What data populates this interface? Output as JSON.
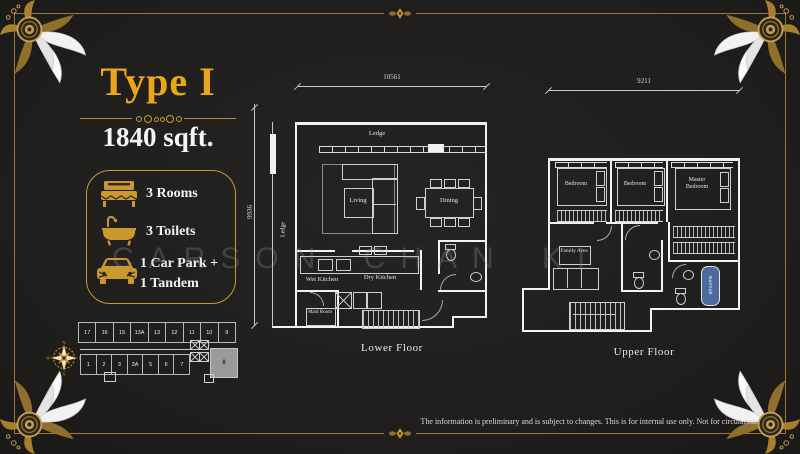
{
  "header": {
    "title": "Type I",
    "area": "1840 sqft."
  },
  "amenities": {
    "rooms": "3 Rooms",
    "toilets": "3 Toilets",
    "carpark_line1": "1 Car Park +",
    "carpark_line2": "1 Tandem"
  },
  "lower_floor": {
    "label": "Lower Floor",
    "dim_top": "10561",
    "dim_left": "9936",
    "rooms": {
      "ledge_top": "Ledge",
      "ledge_left": "Ledge",
      "living": "Living",
      "dining": "Dining",
      "wet_kitchen": "Wet Kitchen",
      "dry_kitchen": "Dry Kitchen",
      "maid_room": "Maid Room"
    }
  },
  "upper_floor": {
    "label": "Upper Floor",
    "dim_top": "9211",
    "rooms": {
      "bedroom1": "Bedroom",
      "bedroom2": "Bedroom",
      "master_bedroom": "Master Bedroom",
      "family_area": "Family Area",
      "bathtub": "Bathtub"
    }
  },
  "key_plan": {
    "top_row": [
      "17",
      "16",
      "15",
      "13A",
      "13",
      "12",
      "11",
      "10",
      "9"
    ],
    "bottom_row": [
      "1",
      "2",
      "3",
      "3A",
      "5",
      "6",
      "7"
    ],
    "highlighted_unit": "8",
    "compass": {
      "n": "N",
      "e": "E",
      "s": "S",
      "w": "W"
    }
  },
  "footer": {
    "disclaimer": "The information is preliminary and is subject to changes. This is for internal use only. Not for circulation."
  },
  "watermark": "CARSON CHAN KI",
  "colors": {
    "gold": "#c9992e",
    "title_gold": "#eaa619",
    "background": "#232120",
    "plan_line": "#f2f2f2",
    "bathtub_blue": "#4a6b9b",
    "highlight_gray": "#9a9a9a"
  }
}
